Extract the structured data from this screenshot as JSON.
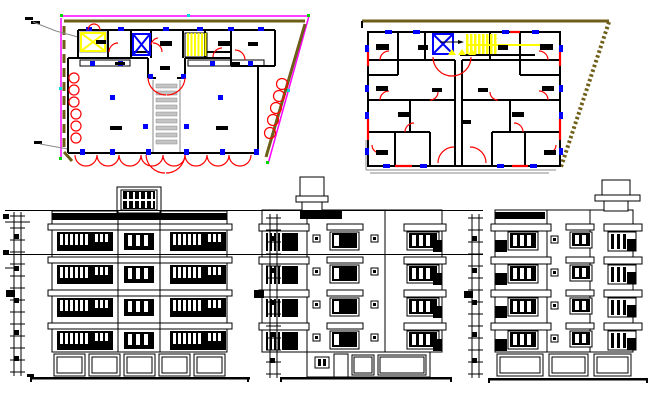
{
  "sheet": {
    "kind": "architectural-cad-sheet",
    "background": "#ffffff"
  },
  "palette": {
    "line": "#000000",
    "white": "#ffffff",
    "magenta": "#ff00ff",
    "olive": "#6e5e17",
    "red": "#fe0000",
    "yellow": "#ffff00",
    "blue": "#0000ff",
    "gray": "#8a8a8a",
    "light_gray": "#c4c4c4",
    "green": "#00d800",
    "cyan": "#00dcdc"
  },
  "figures": {
    "plans": [
      {
        "name": "ground-floor-plan",
        "position": "top-left",
        "lift_shafts": 2,
        "stair_flights": 2,
        "boundary_colors": [
          "magenta",
          "olive"
        ],
        "door_swing_color": "red",
        "column_marker_color": "blue",
        "stair_hatch_color": "yellow"
      },
      {
        "name": "typical-floor-plan",
        "position": "top-right",
        "lift_shafts": 1,
        "stair_flights": 1,
        "boundary_colors": [
          "olive"
        ],
        "door_swing_color": "red",
        "window_marker_color": "blue",
        "stair_hatch_color": "yellow"
      }
    ],
    "elevations": [
      {
        "name": "front-elevation",
        "position": "bottom-left",
        "storeys": 4,
        "ground_floor_openings": 5,
        "rooftop_structure": true,
        "dimension_ladder": true
      },
      {
        "name": "rear-elevation",
        "position": "bottom-middle",
        "storeys": 4,
        "ground_floor_openings": 4,
        "rooftop_structure": true,
        "dimension_ladder": true
      },
      {
        "name": "side-elevation",
        "position": "bottom-right",
        "storeys": 4,
        "ground_floor_openings": 3,
        "rooftop_structure": true,
        "dimension_ladder": true
      }
    ],
    "level_datum_lines": 2
  }
}
